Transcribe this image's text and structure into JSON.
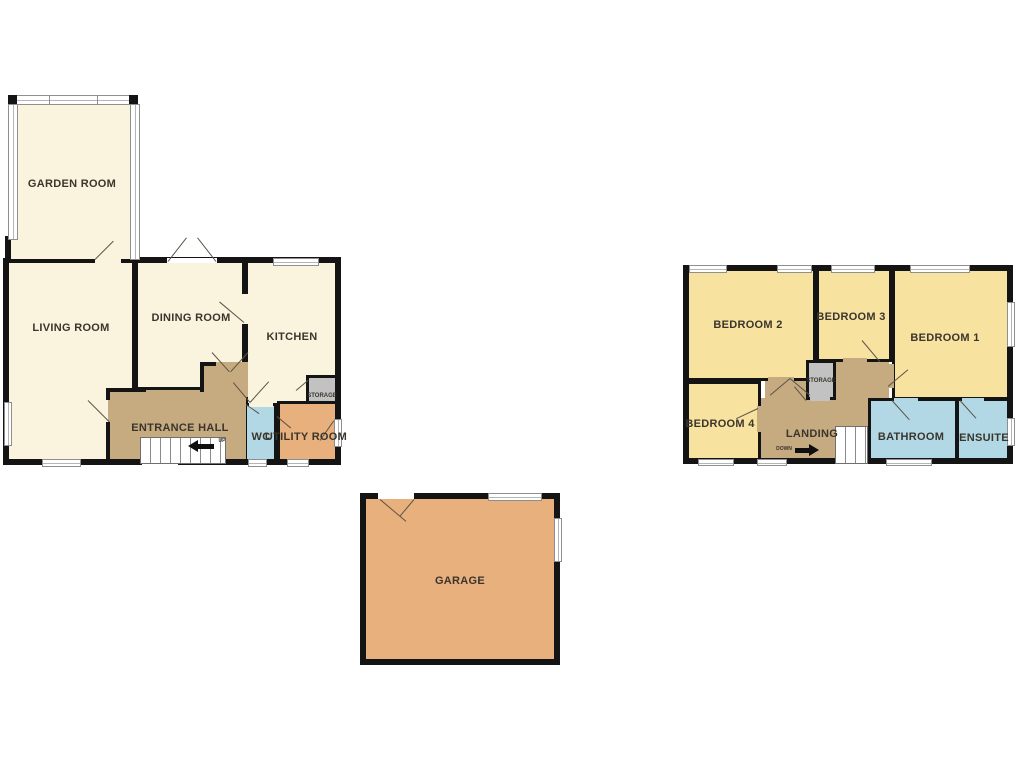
{
  "colors": {
    "wall": "#141414",
    "text": "#3a352d",
    "cream": "#faf3de",
    "yellow": "#f8e2a0",
    "tan": "#c6aa80",
    "blue": "#b2d8e5",
    "orange": "#e8b07c",
    "gray": "#c2c2c2",
    "window_frame": "#8f8f8f"
  },
  "ground_floor": {
    "rooms": {
      "garden_room": "GARDEN ROOM",
      "living_room": "LIVING ROOM",
      "dining_room": "DINING ROOM",
      "kitchen": "KITCHEN",
      "entrance_hall": "ENTRANCE HALL",
      "wc": "WC",
      "utility_room": "UTILITY ROOM",
      "storage": "STORAGE"
    },
    "stairs": {
      "label": "UP",
      "arrow": "arrow-left-icon"
    }
  },
  "first_floor": {
    "rooms": {
      "bedroom_1": "BEDROOM 1",
      "bedroom_2": "BEDROOM 2",
      "bedroom_3": "BEDROOM 3",
      "bedroom_4": "BEDROOM 4",
      "landing": "LANDING",
      "bathroom": "BATHROOM",
      "ensuite": "ENSUITE",
      "storage": "STORAGE"
    },
    "stairs": {
      "label": "DOWN",
      "arrow": "arrow-right-icon"
    }
  },
  "garage": {
    "label": "GARAGE"
  }
}
